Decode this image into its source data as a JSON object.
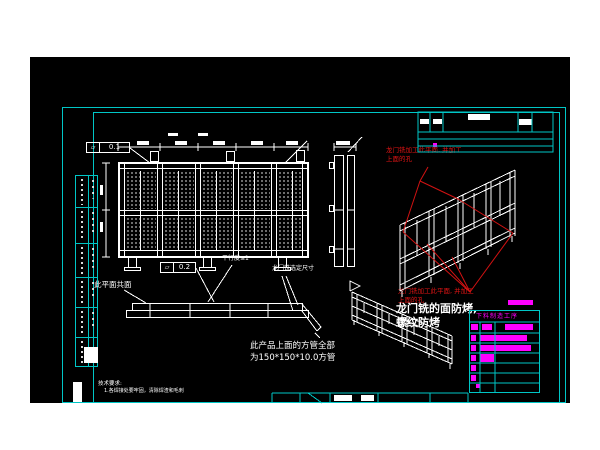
{
  "page": {
    "background": "#ffffff",
    "canvas_color": "#000000"
  },
  "colors": {
    "frame_cyan": "#00c6c6",
    "linework_white": "#ffffff",
    "annotation_red": "#e21414",
    "highlight_magenta": "#ff00ff"
  },
  "callouts": {
    "flatness_symbol": "▱",
    "flatness_top_value": "0.1",
    "flatness_mid_value": "0.2"
  },
  "notes": {
    "coplanar": "此平面共面",
    "parallelism": "平行度≤1",
    "gantry_dimension": "龙门铣选定尺寸",
    "red_top_line1": "龙门铣加工此平面, 并加工",
    "red_top_line2": "上面的孔",
    "red_bottom_line1": "龙门铣加工此平面, 并加工",
    "red_bottom_line2": "上面的孔",
    "bake_protect_line1": "龙门铣的面防烤,",
    "bake_protect_line2": "螺纹防烤",
    "tube_spec_line1": "此产品上面的方管全部",
    "tube_spec_line2": "为150*150*10.0方管",
    "tech_requirements_title": "技术要求:",
    "tech_requirements_item1": "1.各焊接处要牢固，清除焊渣和毛刺"
  },
  "process_table": {
    "title": "下料制造工序"
  }
}
